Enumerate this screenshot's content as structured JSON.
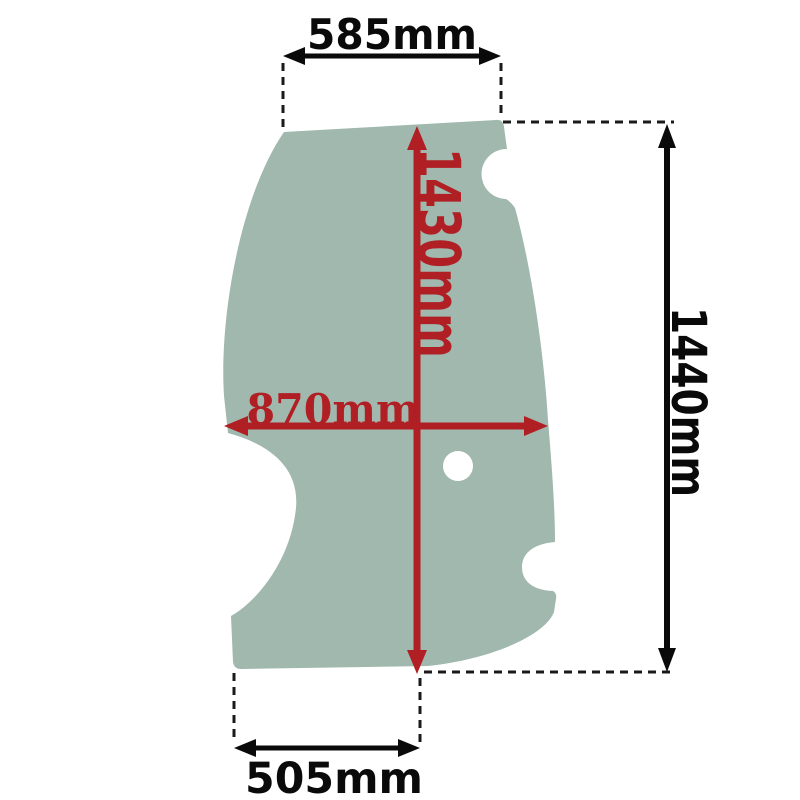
{
  "diagram": {
    "panel": {
      "fill": "#a0b8ae"
    },
    "labels": {
      "top_width": "585mm",
      "inner_height": "1430mm",
      "inner_width": "870mm",
      "overall_height": "1440mm",
      "bottom_width": "505mm"
    },
    "colors": {
      "red_dimension": "#b01f24",
      "black_dimension": "#0a0a0a",
      "background": "#ffffff"
    }
  }
}
